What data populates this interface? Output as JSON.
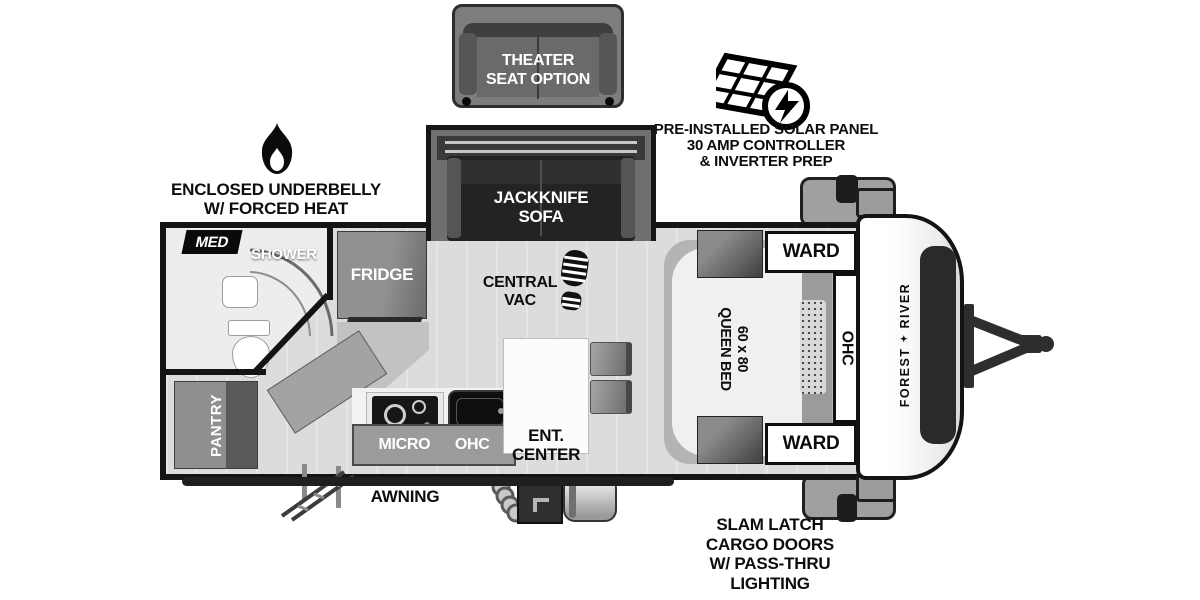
{
  "colors": {
    "outline": "#141414",
    "floor": "#dcdcdc",
    "furniture_gray": "#8f8f8f",
    "dark_upholstery": "#262626",
    "white": "#ffffff"
  },
  "callouts": {
    "theater_seat": {
      "line1": "THEATER",
      "line2": "SEAT OPTION"
    },
    "solar": {
      "line1": "PRE-INSTALLED SOLAR PANEL",
      "line2": "30 AMP CONTROLLER",
      "line3": "& INVERTER PREP"
    },
    "underbelly": {
      "line1": "ENCLOSED UNDERBELLY",
      "line2": "W/ FORCED HEAT"
    },
    "awning": "AWNING",
    "slam_latch": {
      "line1": "SLAM LATCH",
      "line2": "CARGO DOORS",
      "line3": "W/ PASS-THRU",
      "line4": "LIGHTING"
    }
  },
  "labels": {
    "med": "MED",
    "shower": "SHOWER",
    "fridge": "FRIDGE",
    "pantry": "PANTRY",
    "jackknife": {
      "line1": "JACKKNIFE",
      "line2": "SOFA"
    },
    "central_vac": {
      "line1": "CENTRAL",
      "line2": "VAC"
    },
    "micro": "MICRO",
    "kitchen_ohc": "OHC",
    "ent_center": {
      "line1": "ENT.",
      "line2": "CENTER"
    },
    "bed": {
      "line1": "60 x 80",
      "line2": "QUEEN BED"
    },
    "ward_front": "WARD",
    "ward_rear": "WARD",
    "bedroom_ohc": "OHC"
  },
  "brand": {
    "word1": "FOREST",
    "mark": "✦",
    "word2": "RIVER"
  }
}
